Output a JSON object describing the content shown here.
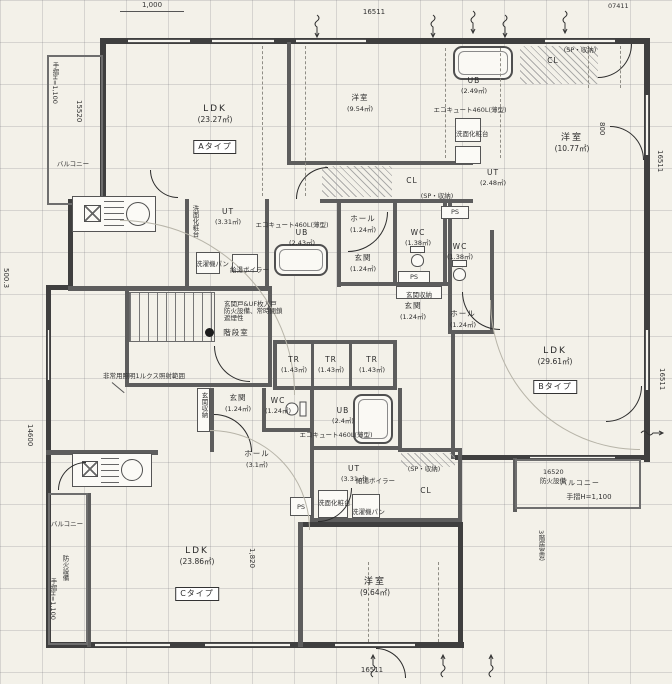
{
  "rooms": {
    "a_ldk": {
      "label": "LDK",
      "area": "(23.27㎡)"
    },
    "a_yoshitsu": {
      "label": "洋室",
      "area": "(9.54㎡)"
    },
    "a_ut": {
      "label": "UT",
      "area": "(3.31㎡)"
    },
    "a_ub": {
      "label": "UB",
      "area": "(2.43㎡)"
    },
    "a_hall": {
      "label": "ホール",
      "area": "(1.24㎡)"
    },
    "a_genkan": {
      "label": "玄関",
      "area": "(1.24㎡)"
    },
    "a_wc": {
      "label": "WC",
      "area": "(1.38㎡)"
    },
    "a_cl": {
      "label": "CL"
    },
    "b_ub": {
      "label": "UB",
      "area": "(2.49㎡)"
    },
    "b_cl": {
      "label": "CL"
    },
    "b_yoshitsu": {
      "label": "洋室",
      "area": "(10.77㎡)"
    },
    "b_ut": {
      "label": "UT",
      "area": "(2.48㎡)"
    },
    "b_wc": {
      "label": "WC",
      "area": "(1.38㎡)"
    },
    "b_genkan": {
      "label": "玄関",
      "area": "(1.24㎡)"
    },
    "b_hall": {
      "label": "ホール",
      "area": "(1.24㎡)"
    },
    "b_ldk": {
      "label": "LDK",
      "area": "(29.61㎡)"
    },
    "c_genkan": {
      "label": "玄関",
      "area": "(1.24㎡)"
    },
    "c_wc": {
      "label": "WC",
      "area": "(1.24㎡)"
    },
    "c_hall": {
      "label": "ホール",
      "area": "(3.1㎡)"
    },
    "c_ub": {
      "label": "UB",
      "area": "(2.4㎡)"
    },
    "c_ut": {
      "label": "UT",
      "area": "(3.31㎡)"
    },
    "c_cl": {
      "label": "CL"
    },
    "c_ldk": {
      "label": "LDK",
      "area": "(23.86㎡)"
    },
    "c_yoshitsu": {
      "label": "洋室",
      "area": "(9.64㎡)"
    },
    "tr": {
      "label": "TR",
      "area": "(1.43㎡)"
    },
    "stair": {
      "label": "階段室"
    },
    "ps": {
      "label": "PS"
    },
    "balcony": {
      "label": "バルコニー"
    }
  },
  "type_labels": {
    "a": "Aタイプ",
    "b": "Bタイプ",
    "c": "Cタイプ"
  },
  "annotations": {
    "emergency_light": "非常用照明1ルクス照射範囲",
    "door_note_1": "玄関戸&UF枚入戸",
    "door_note_2": "防火設備、常時閉鎖",
    "door_note_3": "遮煙性",
    "sp_storage": "(SP・収納)",
    "genkan_storage": "玄関収納",
    "ecocute": "エコキュート460L(薄型)",
    "vanity": "洗面化粧台",
    "washer_pan": "洗濯機パン",
    "boiler": "給湯ボイラー",
    "handrail": "手摺H=1,100",
    "fire_equipment": "防火設備",
    "window_3f": "3階居室窓"
  },
  "dimensions": {
    "top_left": "1,000",
    "top_center": "16511",
    "top_right": "07411",
    "bottom_center": "16511",
    "right_side": "16511",
    "left_upper": "15520",
    "left_mid": "500.3",
    "left_lower": "14600",
    "width_1820": "1,820",
    "height_800": "800",
    "balcony_16520": "16520"
  }
}
